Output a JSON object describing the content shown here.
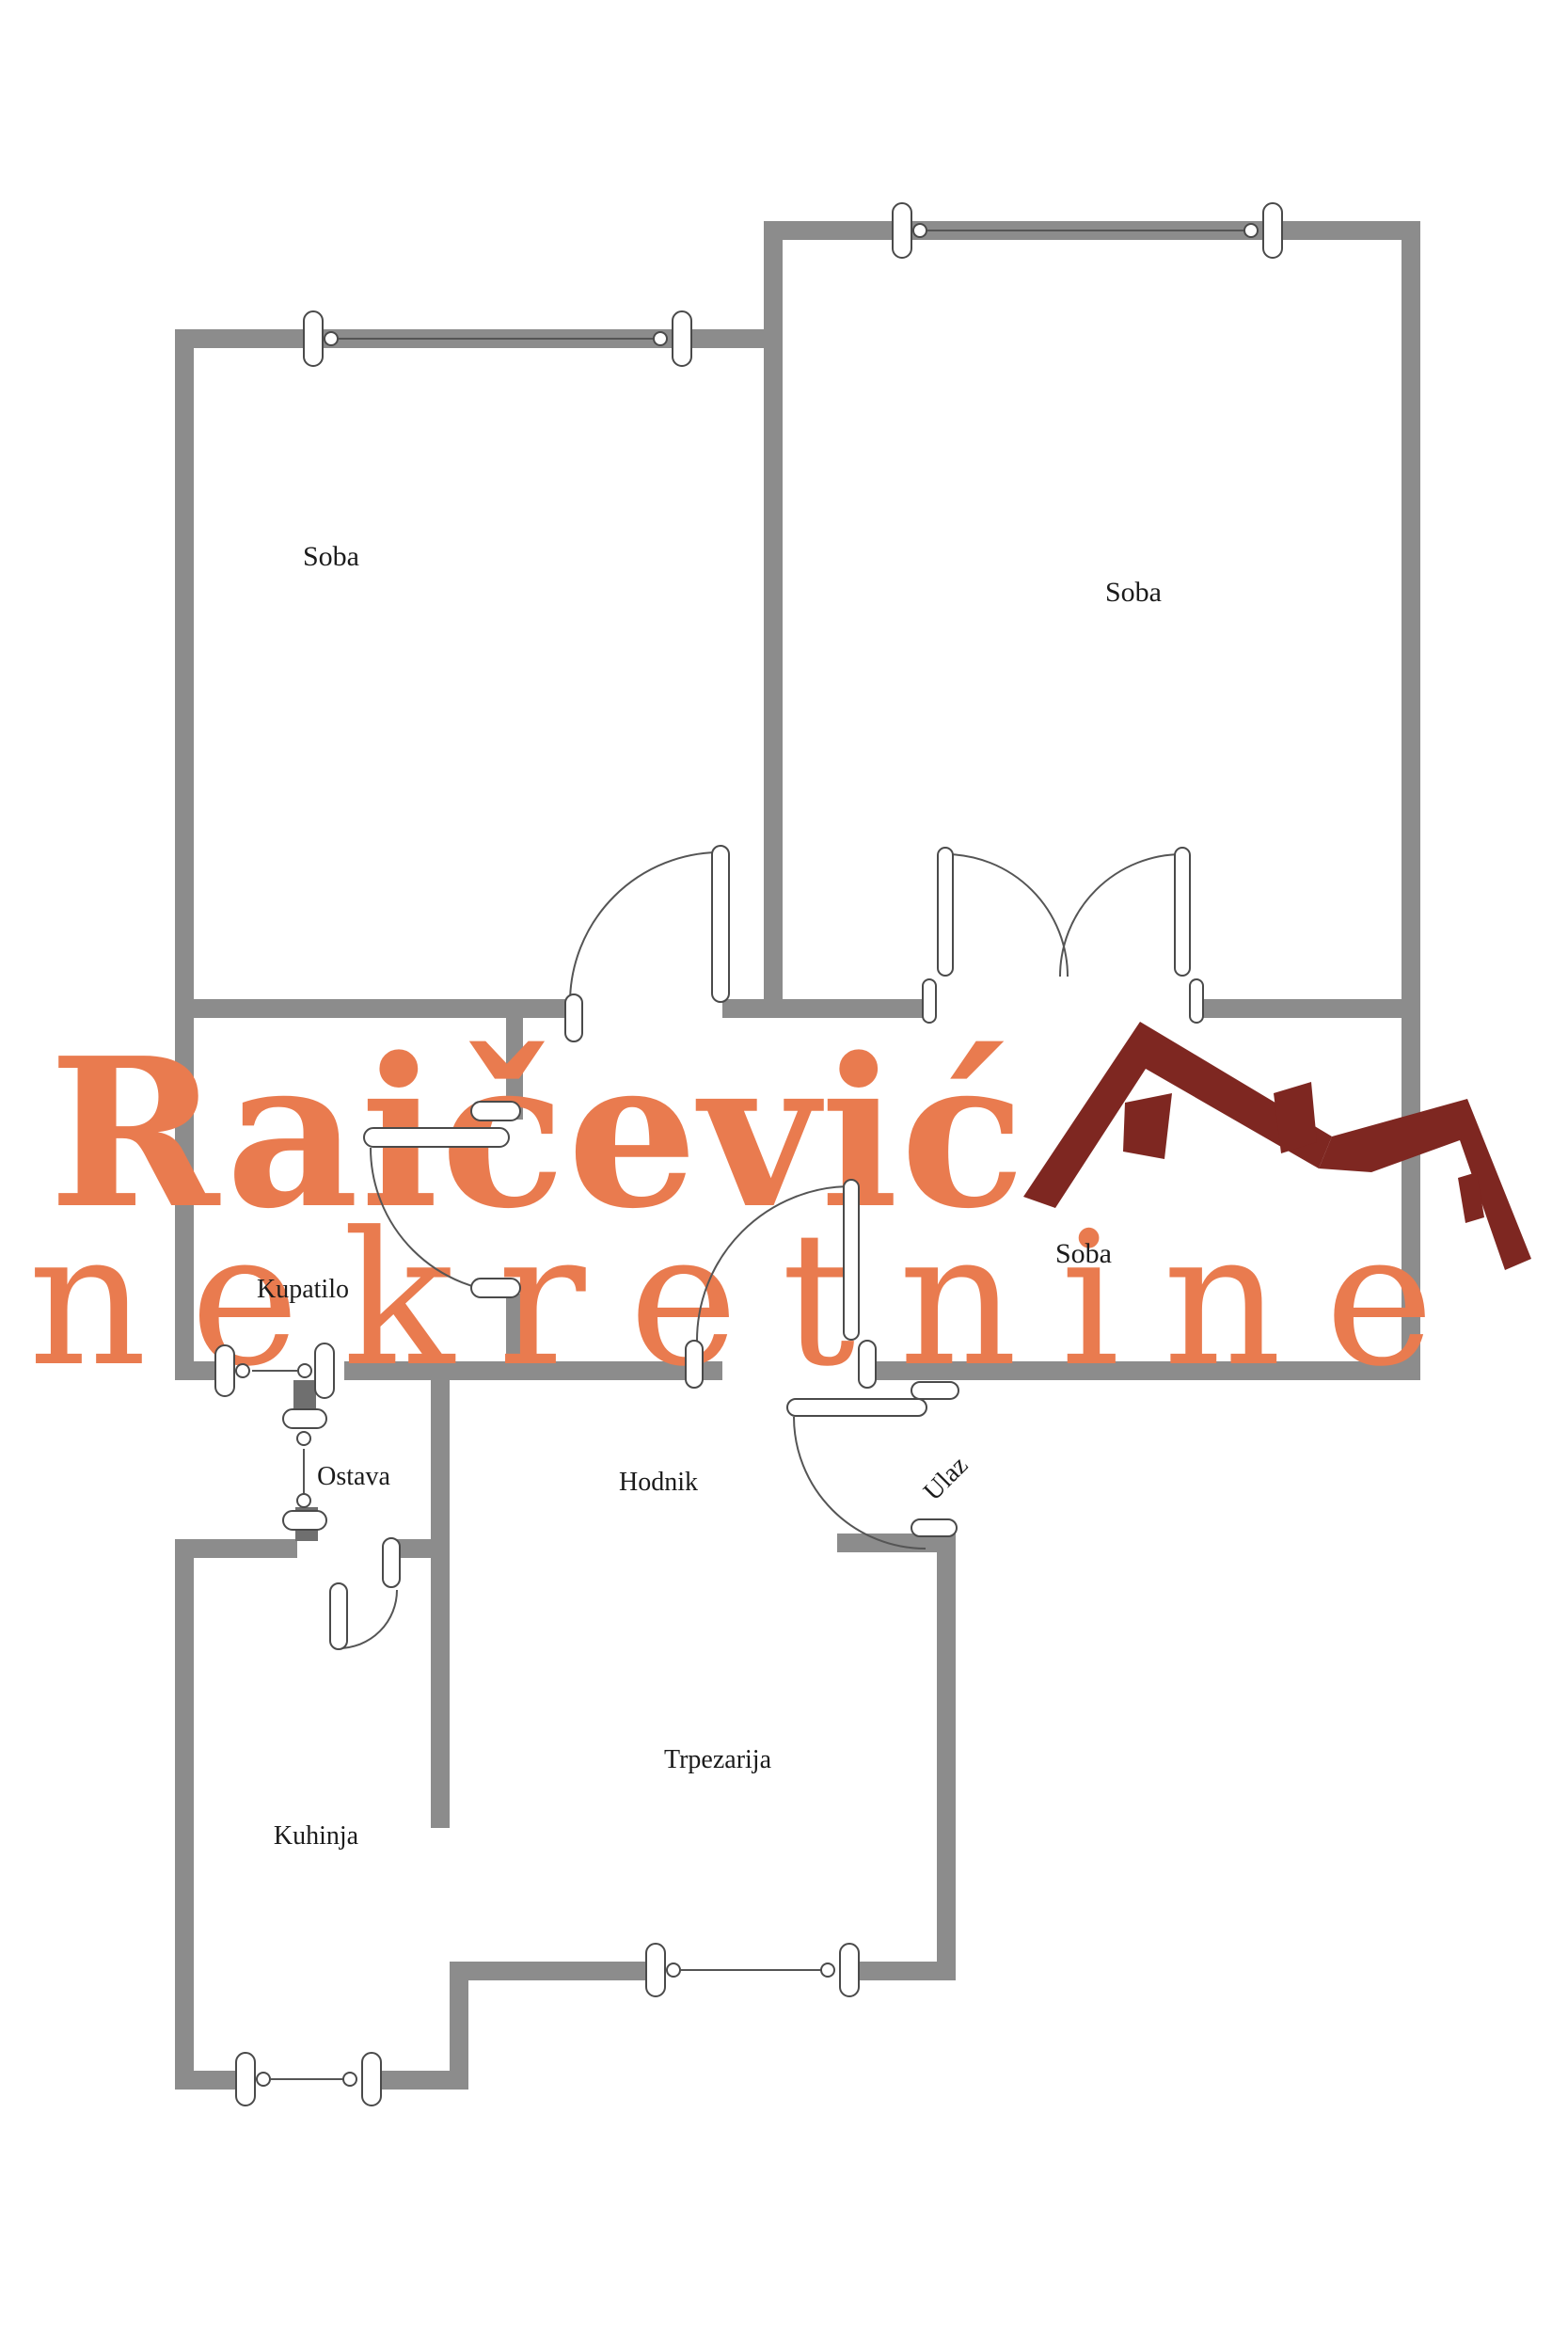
{
  "plan": {
    "labels": {
      "soba_left": "Soba",
      "soba_right": "Soba",
      "soba_middle": "Soba",
      "kupatilo": "Kupatilo",
      "ostava": "Ostava",
      "hodnik": "Hodnik",
      "ulaz": "Ulaz",
      "trpezarija": "Trpezarija",
      "kuhinja": "Kuhinja"
    }
  },
  "watermark": {
    "line1": "Raičević",
    "line2": "nekretnine",
    "text_color": "#E97B4F",
    "roof_color": "#7E2721"
  },
  "colors": {
    "wall": "#8c8c8c",
    "wall_dark": "#6f6f6f",
    "symbol_outline": "#4a4a4a",
    "label_text": "#1b1b1b"
  }
}
